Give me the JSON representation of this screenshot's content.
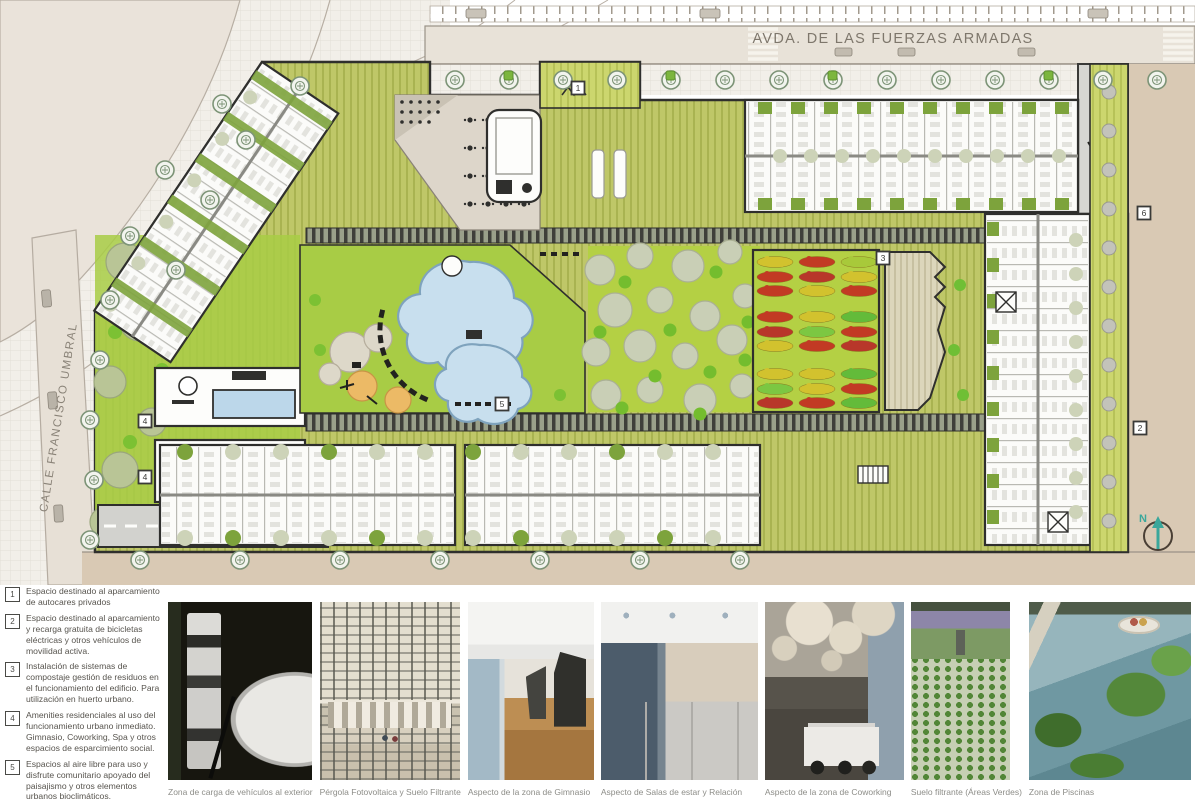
{
  "plan": {
    "streets": {
      "top": "AVDA. DE LAS FUERZAS ARMADAS",
      "left": "CALLE FRANCISCO UMBRAL"
    },
    "north_label": "N",
    "markers": [
      {
        "num": "1",
        "x": 578,
        "y": 88
      },
      {
        "num": "2",
        "x": 1140,
        "y": 428
      },
      {
        "num": "3",
        "x": 883,
        "y": 258
      },
      {
        "num": "4",
        "x": 145,
        "y": 421
      },
      {
        "num": "4",
        "x": 145,
        "y": 477
      },
      {
        "num": "5",
        "x": 502,
        "y": 404
      },
      {
        "num": "6",
        "x": 1144,
        "y": 213
      }
    ],
    "colors": {
      "courtyard_olive": "#bcc468",
      "lawn_green": "#a8cc45",
      "strip_green": "#7da33c",
      "pool_blue": "#c8dfee",
      "crop_red": "#c23a24",
      "crop_yellow": "#d2c22e",
      "crop_green": "#63bb3a",
      "road_beige": "#e8e2d8",
      "plaza_tan": "#d9c9b4",
      "outline_dark": "#2f2f2d",
      "north_teal": "#3aa79b"
    }
  },
  "legend": {
    "items": [
      {
        "num": "1",
        "text": "Espacio destinado al aparcamiento de autocares privados"
      },
      {
        "num": "2",
        "text": "Espacio destinado al aparcamiento y recarga gratuita de bicicletas eléctricas y otros vehículos de movilidad activa."
      },
      {
        "num": "3",
        "text": "Instalación de sistemas de compostaje gestión de residuos en el funcionamiento del edificio. Para utilización en huerto urbano."
      },
      {
        "num": "4",
        "text": "Amenities residenciales al uso del funcionamiento urbano inmediato. Gimnasio, Coworking, Spa y otros espacios de esparcimiento social."
      },
      {
        "num": "5",
        "text": "Espacios al aire libre para uso y disfrute comunitario apoyado del paisajismo y otros elementos urbanos bioclimáticos."
      },
      {
        "num": "6",
        "text": "Espacios destinados al estacionamiento de vehículos para la carga y descarga."
      }
    ]
  },
  "photos": [
    {
      "caption": "Zona de carga de vehículos al exterior"
    },
    {
      "caption": "Pérgola Fotovoltaica y Suelo Filtrante"
    },
    {
      "caption": "Aspecto de la zona de Gimnasio"
    },
    {
      "caption": "Aspecto de Salas de estar y Relación"
    },
    {
      "caption": "Aspecto de la zona de Coworking"
    },
    {
      "caption": "Suelo filtrante (Áreas Verdes)"
    },
    {
      "caption": "Zona de Piscinas"
    }
  ]
}
